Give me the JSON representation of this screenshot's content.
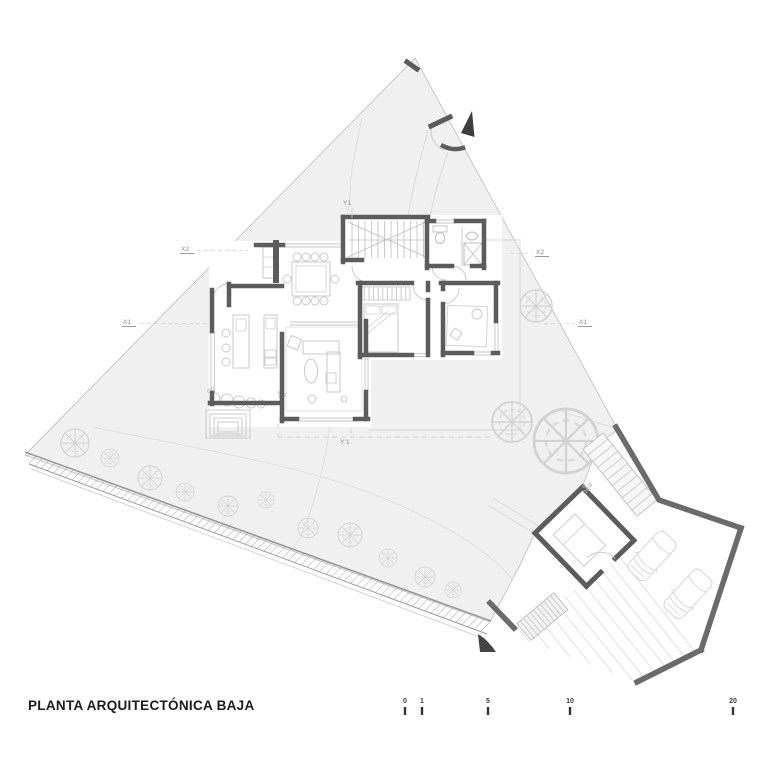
{
  "drawing": {
    "title": "PLANTA ARQUITECTÓNICA BAJA",
    "axis_labels": {
      "x1_left": "X1",
      "x1_right": "X1",
      "x2_left": "X2",
      "x2_right": "X2",
      "y_top": "Y1",
      "y_bottom": "Y'1"
    },
    "scale_bar": {
      "ticks": [
        "0",
        "1",
        "5",
        "10",
        "20"
      ]
    },
    "colors": {
      "site_fill": "#f0f0f0",
      "wall": "#5c5c5c",
      "boundary": "#8f8f8f",
      "thin_line": "#c4c4c4",
      "furniture": "#c9c9c9",
      "vegetation": "#d2d2d2",
      "title_text": "#1c1c1c",
      "axis_text": "#8a8a8a"
    }
  }
}
